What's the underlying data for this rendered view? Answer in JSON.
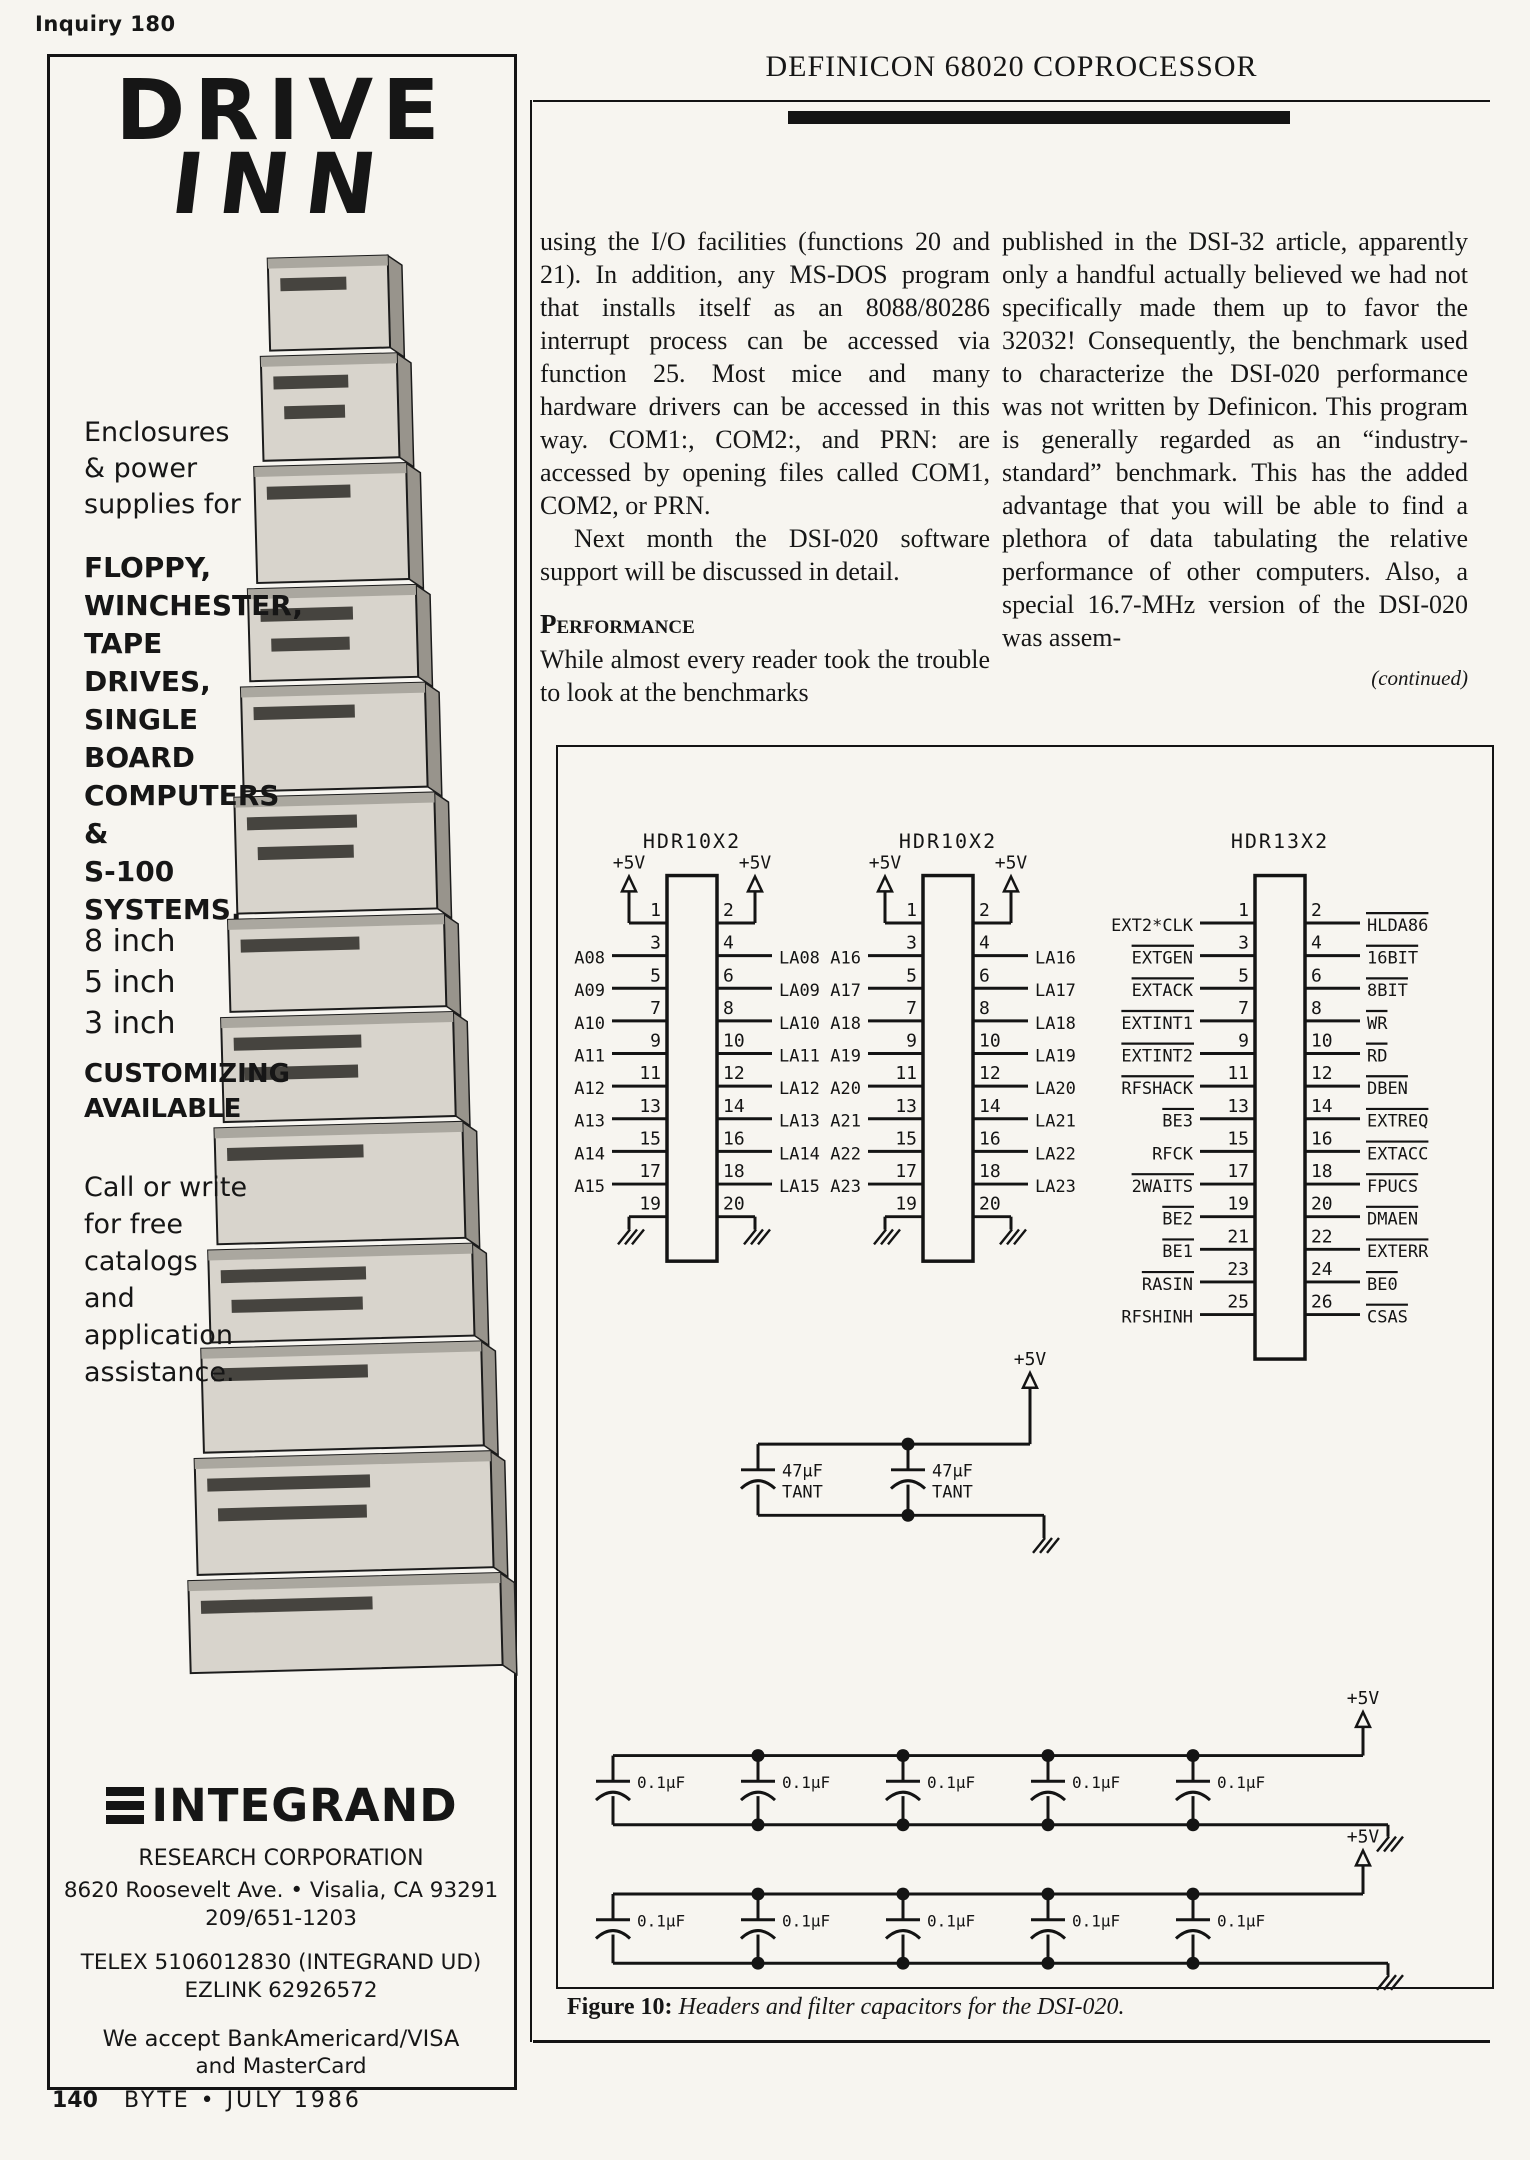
{
  "page": {
    "inquiry": "Inquiry 180",
    "page_number": "140",
    "footer": "BYTE • JULY 1986"
  },
  "ad": {
    "logo_line1": "DRIVE",
    "logo_line2": "INN",
    "intro": "Enclosures\n& power\nsupplies for",
    "products": [
      "FLOPPY,",
      "WINCHESTER,",
      "TAPE DRIVES,",
      "SINGLE",
      "BOARD",
      "COMPUTERS",
      "&",
      "S-100",
      "SYSTEMS."
    ],
    "sizes": [
      "8 inch",
      "5 inch",
      "3 inch"
    ],
    "customizing": "CUSTOMIZING\nAVAILABLE",
    "call_text": "Call or write\nfor free\ncatalogs\nand\napplication\nassistance.",
    "company": "INTEGRAND",
    "division": "RESEARCH CORPORATION",
    "address": "8620 Roosevelt Ave.  •  Visalia, CA 93291",
    "phone": "209/651-1203",
    "telex": "TELEX 5106012830 (INTEGRAND UD)",
    "ezlink": "EZLINK 62926572",
    "accept_line1": "We accept BankAmericard/VISA",
    "accept_line2": "and MasterCard"
  },
  "article": {
    "title": "DEFINICON 68020 COPROCESSOR",
    "col1_p1": "using the I/O facilities (functions 20 and 21). In addition, any MS-DOS program that installs itself as an 8088/80286 interrupt process can be accessed via function 25. Most mice and many hardware drivers can be accessed in this way. COM1:, COM2:, and PRN: are accessed by opening files called COM1, COM2, or PRN.",
    "col1_p2": "Next month the DSI-020 software support will be discussed in detail.",
    "heading": "Performance",
    "col1_p3": "While almost every reader took the trouble to look at the benchmarks",
    "col2_p1": "published in the DSI-32 article, apparently only a handful actually believed we had not specifically made them up to favor the 32032! Consequently, the benchmark used to characterize the DSI-020 performance was not written by Definicon. This program is generally regarded as an “industry-standard” benchmark. This has the added advantage that you will be able to find a plethora of data tabulating the relative performance of other computers. Also, a special 16.7-MHz version of the DSI-020 was assem-",
    "continued": "(continued)"
  },
  "figure": {
    "caption_label": "Figure 10:",
    "caption": "Headers and filter capacitors for the DSI-020.",
    "power_label": "+5V",
    "headers": [
      {
        "name": "HDR10X2",
        "rows": 10,
        "power": true,
        "ground": true,
        "left": [
          {
            "pin": 3,
            "label": "A08"
          },
          {
            "pin": 5,
            "label": "A09"
          },
          {
            "pin": 7,
            "label": "A10"
          },
          {
            "pin": 9,
            "label": "A11"
          },
          {
            "pin": 11,
            "label": "A12"
          },
          {
            "pin": 13,
            "label": "A13"
          },
          {
            "pin": 15,
            "label": "A14"
          },
          {
            "pin": 17,
            "label": "A15"
          }
        ],
        "right": [
          {
            "pin": 4,
            "label": "LA08"
          },
          {
            "pin": 6,
            "label": "LA09"
          },
          {
            "pin": 8,
            "label": "LA10"
          },
          {
            "pin": 10,
            "label": "LA11"
          },
          {
            "pin": 12,
            "label": "LA12"
          },
          {
            "pin": 14,
            "label": "LA13"
          },
          {
            "pin": 16,
            "label": "LA14"
          },
          {
            "pin": 18,
            "label": "LA15"
          }
        ]
      },
      {
        "name": "HDR10X2",
        "rows": 10,
        "power": true,
        "ground": true,
        "left": [
          {
            "pin": 3,
            "label": "A16"
          },
          {
            "pin": 5,
            "label": "A17"
          },
          {
            "pin": 7,
            "label": "A18"
          },
          {
            "pin": 9,
            "label": "A19"
          },
          {
            "pin": 11,
            "label": "A20"
          },
          {
            "pin": 13,
            "label": "A21"
          },
          {
            "pin": 15,
            "label": "A22"
          },
          {
            "pin": 17,
            "label": "A23"
          }
        ],
        "right": [
          {
            "pin": 4,
            "label": "LA16"
          },
          {
            "pin": 6,
            "label": "LA17"
          },
          {
            "pin": 8,
            "label": "LA18"
          },
          {
            "pin": 10,
            "label": "LA19"
          },
          {
            "pin": 12,
            "label": "LA20"
          },
          {
            "pin": 14,
            "label": "LA21"
          },
          {
            "pin": 16,
            "label": "LA22"
          },
          {
            "pin": 18,
            "label": "LA23"
          }
        ]
      },
      {
        "name": "HDR13X2",
        "rows": 13,
        "power": false,
        "ground": false,
        "left": [
          {
            "pin": 1,
            "label": "EXT2*CLK"
          },
          {
            "pin": 3,
            "label": "EXTGEN",
            "bar": true
          },
          {
            "pin": 5,
            "label": "EXTACK",
            "bar": true
          },
          {
            "pin": 7,
            "label": "EXTINT1",
            "bar": true
          },
          {
            "pin": 9,
            "label": "EXTINT2",
            "bar": true
          },
          {
            "pin": 11,
            "label": "RFSHACK",
            "bar": true
          },
          {
            "pin": 13,
            "label": "BE3",
            "bar": true
          },
          {
            "pin": 15,
            "label": "RFCK"
          },
          {
            "pin": 17,
            "label": "2WAITS",
            "bar": true
          },
          {
            "pin": 19,
            "label": "BE2",
            "bar": true
          },
          {
            "pin": 21,
            "label": "BE1",
            "bar": true
          },
          {
            "pin": 23,
            "label": "RASIN",
            "bar": true
          },
          {
            "pin": 25,
            "label": "RFSHINH"
          }
        ],
        "right": [
          {
            "pin": 2,
            "label": "HLDA86",
            "bar": true
          },
          {
            "pin": 4,
            "label": "16BIT",
            "bar": true
          },
          {
            "pin": 6,
            "label": "8BIT",
            "bar": true
          },
          {
            "pin": 8,
            "label": "WR",
            "bar": true
          },
          {
            "pin": 10,
            "label": "RD",
            "bar": true
          },
          {
            "pin": 12,
            "label": "DBEN",
            "bar": true
          },
          {
            "pin": 14,
            "label": "EXTREQ",
            "bar": true
          },
          {
            "pin": 16,
            "label": "EXTACC",
            "bar": true
          },
          {
            "pin": 18,
            "label": "FPUCS",
            "bar": true
          },
          {
            "pin": 20,
            "label": "DMAEN",
            "bar": true
          },
          {
            "pin": 22,
            "label": "EXTERR",
            "bar": true
          },
          {
            "pin": 24,
            "label": "BE0",
            "bar": true
          },
          {
            "pin": 26,
            "label": "CSAS",
            "bar": true
          }
        ]
      }
    ],
    "tantalum": {
      "value": "47µF",
      "type": "TANT",
      "count": 2
    },
    "bypass": {
      "value": "0.1µF",
      "per_row": 5,
      "rows": 2
    }
  }
}
